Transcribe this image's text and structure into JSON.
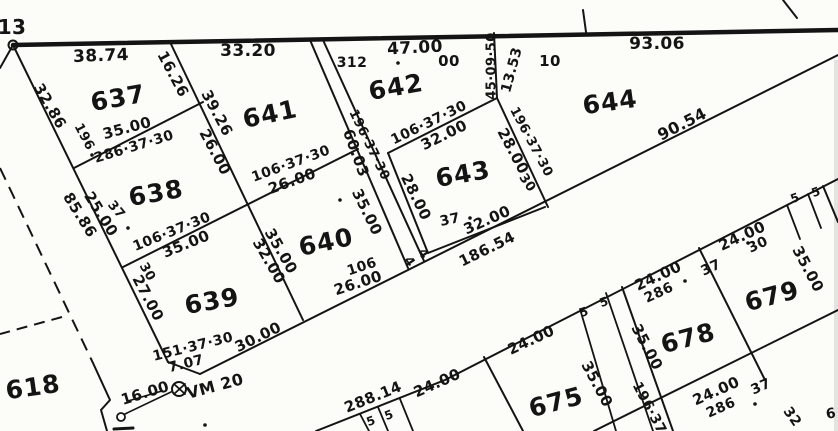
{
  "map": {
    "type": "cadastral-plat",
    "background": "#fcfcf8",
    "ink": "#141414",
    "parcel_numbers": [
      {
        "t": "618",
        "x": 33,
        "y": 387,
        "r": -8
      },
      {
        "t": "637",
        "x": 118,
        "y": 98,
        "r": -10
      },
      {
        "t": "638",
        "x": 156,
        "y": 193,
        "r": -10
      },
      {
        "t": "639",
        "x": 212,
        "y": 301,
        "r": -10
      },
      {
        "t": "640",
        "x": 326,
        "y": 242,
        "r": -12
      },
      {
        "t": "641",
        "x": 270,
        "y": 114,
        "r": -12
      },
      {
        "t": "642",
        "x": 396,
        "y": 87,
        "r": -10
      },
      {
        "t": "643",
        "x": 463,
        "y": 174,
        "r": -10
      },
      {
        "t": "644",
        "x": 610,
        "y": 102,
        "r": -8
      },
      {
        "t": "675",
        "x": 556,
        "y": 402,
        "r": -15
      },
      {
        "t": "678",
        "x": 688,
        "y": 338,
        "r": -15
      },
      {
        "t": "679",
        "x": 772,
        "y": 296,
        "r": -15
      }
    ],
    "labels": [
      {
        "t": "13",
        "x": 12,
        "y": 27,
        "r": 0,
        "s": 20
      },
      {
        "t": "38.74",
        "x": 101,
        "y": 56,
        "r": -2,
        "s": 17
      },
      {
        "t": "33.20",
        "x": 248,
        "y": 51,
        "r": 0,
        "s": 17
      },
      {
        "t": "47.00",
        "x": 415,
        "y": 48,
        "r": -3,
        "s": 17
      },
      {
        "t": "93.06",
        "x": 657,
        "y": 44,
        "r": 0,
        "s": 17
      },
      {
        "t": "312",
        "x": 352,
        "y": 63,
        "r": 0,
        "s": 14
      },
      {
        "t": "00",
        "x": 449,
        "y": 61,
        "r": 0,
        "s": 15
      },
      {
        "t": "10",
        "x": 550,
        "y": 61,
        "r": 0,
        "s": 15
      },
      {
        "t": "16.26",
        "x": 173,
        "y": 74,
        "r": 62,
        "s": 15
      },
      {
        "t": "39.26",
        "x": 217,
        "y": 113,
        "r": 62,
        "s": 15
      },
      {
        "t": "26.00",
        "x": 215,
        "y": 152,
        "r": 62,
        "s": 15
      },
      {
        "t": "32.86",
        "x": 50,
        "y": 106,
        "r": 60,
        "s": 15
      },
      {
        "t": "196",
        "x": 84,
        "y": 137,
        "r": 62,
        "s": 13
      },
      {
        "t": "35.00",
        "x": 127,
        "y": 128,
        "r": -15,
        "s": 15
      },
      {
        "t": "286·37·30",
        "x": 134,
        "y": 147,
        "r": -17,
        "s": 14
      },
      {
        "t": "85.86",
        "x": 80,
        "y": 215,
        "r": 58,
        "s": 15
      },
      {
        "t": "25.00",
        "x": 101,
        "y": 214,
        "r": 58,
        "s": 15
      },
      {
        "t": "37",
        "x": 116,
        "y": 210,
        "r": 50,
        "s": 13
      },
      {
        "t": "106·37·30",
        "x": 172,
        "y": 232,
        "r": -22,
        "s": 14
      },
      {
        "t": "35.00",
        "x": 186,
        "y": 244,
        "r": -22,
        "s": 15
      },
      {
        "t": "30",
        "x": 147,
        "y": 272,
        "r": 60,
        "s": 13
      },
      {
        "t": "27.00",
        "x": 148,
        "y": 298,
        "r": 62,
        "s": 15
      },
      {
        "t": "151·37·30",
        "x": 193,
        "y": 347,
        "r": -14,
        "s": 14
      },
      {
        "t": "7.07",
        "x": 186,
        "y": 364,
        "r": -14,
        "s": 14
      },
      {
        "t": "30.00",
        "x": 258,
        "y": 337,
        "r": -26,
        "s": 15
      },
      {
        "t": "16.00",
        "x": 145,
        "y": 393,
        "r": -17,
        "s": 15
      },
      {
        "t": "VM 20",
        "x": 215,
        "y": 386,
        "r": -15,
        "s": 16
      },
      {
        "t": "106·37·30",
        "x": 291,
        "y": 164,
        "r": -20,
        "s": 14
      },
      {
        "t": "26.00",
        "x": 292,
        "y": 181,
        "r": -20,
        "s": 15
      },
      {
        "t": "35.00",
        "x": 281,
        "y": 251,
        "r": 60,
        "s": 15
      },
      {
        "t": "32.00",
        "x": 269,
        "y": 261,
        "r": 60,
        "s": 15
      },
      {
        "t": "106",
        "x": 362,
        "y": 267,
        "r": -18,
        "s": 14
      },
      {
        "t": "26.00",
        "x": 358,
        "y": 283,
        "r": -18,
        "s": 15
      },
      {
        "t": "60.03",
        "x": 356,
        "y": 153,
        "r": 70,
        "s": 15
      },
      {
        "t": "196·37·30",
        "x": 369,
        "y": 145,
        "r": 64,
        "s": 13
      },
      {
        "t": "35.00",
        "x": 367,
        "y": 212,
        "r": 64,
        "s": 15
      },
      {
        "t": "4",
        "x": 409,
        "y": 262,
        "r": 55,
        "s": 13
      },
      {
        "t": "4",
        "x": 423,
        "y": 254,
        "r": 55,
        "s": 13
      },
      {
        "t": "106·37·30",
        "x": 429,
        "y": 123,
        "r": -26,
        "s": 14
      },
      {
        "t": "32.00",
        "x": 444,
        "y": 135,
        "r": -26,
        "s": 15
      },
      {
        "t": "28.00",
        "x": 416,
        "y": 197,
        "r": 64,
        "s": 15
      },
      {
        "t": "37",
        "x": 450,
        "y": 220,
        "r": -12,
        "s": 14
      },
      {
        "t": "32.00",
        "x": 487,
        "y": 220,
        "r": -24,
        "s": 15
      },
      {
        "t": "186.54",
        "x": 487,
        "y": 249,
        "r": -26,
        "s": 15
      },
      {
        "t": "45·09·50",
        "x": 492,
        "y": 66,
        "r": -90,
        "s": 13
      },
      {
        "t": "13.53",
        "x": 512,
        "y": 70,
        "r": -75,
        "s": 14
      },
      {
        "t": "196·37·30",
        "x": 531,
        "y": 142,
        "r": 62,
        "s": 13
      },
      {
        "t": "28.00",
        "x": 513,
        "y": 151,
        "r": 62,
        "s": 15
      },
      {
        "t": "30",
        "x": 527,
        "y": 183,
        "r": 55,
        "s": 13
      },
      {
        "t": "90.54",
        "x": 682,
        "y": 124,
        "r": -27,
        "s": 16
      },
      {
        "t": "288.14",
        "x": 373,
        "y": 397,
        "r": -22,
        "s": 15
      },
      {
        "t": "24.00",
        "x": 437,
        "y": 383,
        "r": -24,
        "s": 15
      },
      {
        "t": "5",
        "x": 371,
        "y": 421,
        "r": -20,
        "s": 12
      },
      {
        "t": "5",
        "x": 389,
        "y": 415,
        "r": -20,
        "s": 12
      },
      {
        "t": "24.00",
        "x": 531,
        "y": 340,
        "r": -25,
        "s": 15
      },
      {
        "t": "5",
        "x": 584,
        "y": 312,
        "r": -20,
        "s": 12
      },
      {
        "t": "5",
        "x": 604,
        "y": 302,
        "r": -20,
        "s": 12
      },
      {
        "t": "35.00",
        "x": 597,
        "y": 384,
        "r": 62,
        "s": 15
      },
      {
        "t": "35.00",
        "x": 647,
        "y": 347,
        "r": 62,
        "s": 15
      },
      {
        "t": "196·37",
        "x": 649,
        "y": 408,
        "r": 62,
        "s": 14
      },
      {
        "t": "24.00",
        "x": 658,
        "y": 276,
        "r": -25,
        "s": 15
      },
      {
        "t": "286",
        "x": 659,
        "y": 293,
        "r": -25,
        "s": 14
      },
      {
        "t": "37",
        "x": 711,
        "y": 268,
        "r": -25,
        "s": 14
      },
      {
        "t": "24.00",
        "x": 742,
        "y": 236,
        "r": -25,
        "s": 15
      },
      {
        "t": "30",
        "x": 758,
        "y": 245,
        "r": -25,
        "s": 14
      },
      {
        "t": "35.00",
        "x": 808,
        "y": 269,
        "r": 62,
        "s": 15
      },
      {
        "t": "5",
        "x": 795,
        "y": 198,
        "r": -20,
        "s": 12
      },
      {
        "t": "5",
        "x": 816,
        "y": 192,
        "r": -20,
        "s": 12
      },
      {
        "t": "24.00",
        "x": 716,
        "y": 391,
        "r": -24,
        "s": 15
      },
      {
        "t": "37",
        "x": 761,
        "y": 387,
        "r": -24,
        "s": 14
      },
      {
        "t": "286",
        "x": 721,
        "y": 408,
        "r": -24,
        "s": 14
      },
      {
        "t": "32",
        "x": 792,
        "y": 417,
        "r": 55,
        "s": 14
      },
      {
        "t": "6",
        "x": 831,
        "y": 414,
        "r": -10,
        "s": 14
      }
    ],
    "lines": [
      {
        "x1": 13,
        "y1": 45,
        "x2": 838,
        "y2": 30,
        "w": 4.5,
        "n": "street-boundary-top"
      },
      {
        "x1": 13,
        "y1": 45,
        "x2": 0,
        "y2": 68,
        "w": 2,
        "n": "boundary-stub-left"
      },
      {
        "x1": 13,
        "y1": 45,
        "x2": 168,
        "y2": 362,
        "w": 2,
        "n": "west-diagonal-boundary"
      },
      {
        "x1": 168,
        "y1": 362,
        "x2": 200,
        "y2": 374,
        "w": 2,
        "n": "corner-chamfer-7-07"
      },
      {
        "x1": 200,
        "y1": 374,
        "x2": 838,
        "y2": 55,
        "w": 2,
        "n": "road-edge-upper"
      },
      {
        "x1": 170,
        "y1": 42,
        "x2": 303,
        "y2": 320,
        "w": 2,
        "n": "boundary-637-641"
      },
      {
        "x1": 74,
        "y1": 168,
        "x2": 203,
        "y2": 102,
        "w": 2,
        "n": "boundary-637-638"
      },
      {
        "x1": 123,
        "y1": 267,
        "x2": 358,
        "y2": 149,
        "w": 2,
        "n": "boundary-638-639-640-641"
      },
      {
        "x1": 310,
        "y1": 40,
        "x2": 408,
        "y2": 268,
        "w": 2,
        "n": "lane-strip-west"
      },
      {
        "x1": 323,
        "y1": 40,
        "x2": 424,
        "y2": 261,
        "w": 2,
        "n": "lane-strip-east"
      },
      {
        "x1": 388,
        "y1": 153,
        "x2": 497,
        "y2": 98,
        "w": 2,
        "n": "boundary-642-643"
      },
      {
        "x1": 494,
        "y1": 33,
        "x2": 497,
        "y2": 98,
        "w": 2,
        "n": "boundary-45-09-50"
      },
      {
        "x1": 497,
        "y1": 98,
        "x2": 548,
        "y2": 207,
        "w": 2,
        "n": "boundary-643-644"
      },
      {
        "x1": 388,
        "y1": 153,
        "x2": 428,
        "y2": 253,
        "w": 2,
        "n": "boundary-643-west"
      },
      {
        "x1": 428,
        "y1": 253,
        "x2": 545,
        "y2": 207,
        "w": 2,
        "n": "boundary-643-south"
      },
      {
        "x1": 583,
        "y1": 10,
        "x2": 586,
        "y2": 32,
        "w": 2,
        "n": "top-tick"
      },
      {
        "x1": 783,
        "y1": 0,
        "x2": 797,
        "y2": 18,
        "w": 2,
        "n": "top-right-diagonal"
      },
      {
        "x1": 594,
        "y1": 431,
        "x2": 838,
        "y2": 310,
        "w": 2,
        "n": "road-edge-second-lower"
      },
      {
        "x1": 360,
        "y1": 414,
        "x2": 369,
        "y2": 431,
        "w": 1.8,
        "n": "five-strip-line"
      },
      {
        "x1": 378,
        "y1": 407,
        "x2": 388,
        "y2": 431,
        "w": 1.8,
        "n": "five-strip-line"
      },
      {
        "x1": 400,
        "y1": 399,
        "x2": 413,
        "y2": 431,
        "w": 1.8,
        "n": "five-strip-line"
      },
      {
        "x1": 484,
        "y1": 357,
        "x2": 523,
        "y2": 431,
        "w": 2,
        "n": "boundary-675-west"
      },
      {
        "x1": 580,
        "y1": 309,
        "x2": 616,
        "y2": 431,
        "w": 1.8,
        "n": "five-strip-line"
      },
      {
        "x1": 606,
        "y1": 293,
        "x2": 653,
        "y2": 431,
        "w": 1.8,
        "n": "five-strip-line"
      },
      {
        "x1": 622,
        "y1": 287,
        "x2": 673,
        "y2": 431,
        "w": 2,
        "n": "boundary-675-678"
      },
      {
        "x1": 699,
        "y1": 248,
        "x2": 765,
        "y2": 380,
        "w": 2,
        "n": "boundary-678-679"
      },
      {
        "x1": 787,
        "y1": 205,
        "x2": 800,
        "y2": 239,
        "w": 1.8,
        "n": "five-strip-line"
      },
      {
        "x1": 808,
        "y1": 194,
        "x2": 821,
        "y2": 228,
        "w": 1.8,
        "n": "five-strip-line"
      },
      {
        "x1": 823,
        "y1": 186,
        "x2": 838,
        "y2": 222,
        "w": 2,
        "n": "boundary-679-east"
      },
      {
        "x1": 125,
        "y1": 414,
        "x2": 171,
        "y2": 392,
        "w": 1.6,
        "n": "tie-line-16-00"
      },
      {
        "x1": 128,
        "y1": 401,
        "x2": 162,
        "y2": 391,
        "w": 1.5,
        "n": "underline-16-00"
      },
      {
        "x1": 114,
        "y1": 429,
        "x2": 133,
        "y2": 428,
        "w": 3,
        "n": "bottom-edge-stub"
      },
      {
        "x1": 174,
        "y1": 384,
        "x2": 185,
        "y2": 394,
        "w": 1.8,
        "n": "vm-marker-cross"
      },
      {
        "x1": 185,
        "y1": 384,
        "x2": 174,
        "y2": 394,
        "w": 1.8,
        "n": "vm-marker-cross"
      }
    ],
    "polylines": [
      {
        "pts": "316,431 445,380 838,179",
        "w": 2,
        "n": "road-edge-lower"
      },
      {
        "pts": "93,363 110,400 101,410 107,431",
        "w": 2,
        "n": "boundary-zigzag-618"
      }
    ],
    "dashed_lines": [
      {
        "x1": 0,
        "y1": 168,
        "x2": 93,
        "y2": 363,
        "w": 2,
        "dash": "13 8",
        "n": "dashed-boundary-618"
      },
      {
        "x1": 62,
        "y1": 317,
        "x2": 0,
        "y2": 334,
        "w": 2,
        "dash": "11 7",
        "n": "dashed-boundary-618-branch"
      }
    ],
    "circles": [
      {
        "cx": 13,
        "cy": 45,
        "rr": 4.5,
        "w": 2,
        "n": "boundary-node"
      },
      {
        "cx": 179,
        "cy": 389,
        "rr": 7,
        "w": 2,
        "n": "survey-marker-vm20"
      },
      {
        "cx": 121,
        "cy": 417,
        "rr": 4,
        "w": 1.8,
        "n": "survey-point"
      }
    ],
    "dots": [
      {
        "cx": 398,
        "cy": 63
      },
      {
        "cx": 92,
        "cy": 155
      },
      {
        "cx": 128,
        "cy": 228
      },
      {
        "cx": 340,
        "cy": 200
      },
      {
        "cx": 470,
        "cy": 218
      },
      {
        "cx": 685,
        "cy": 281
      },
      {
        "cx": 748,
        "cy": 243
      },
      {
        "cx": 755,
        "cy": 404
      },
      {
        "cx": 205,
        "cy": 425
      }
    ],
    "rects": [
      {
        "x": 834,
        "y": 60,
        "w": 4,
        "h": 371,
        "fill": "#e3e3df",
        "n": "scan-edge-artifact"
      }
    ]
  }
}
